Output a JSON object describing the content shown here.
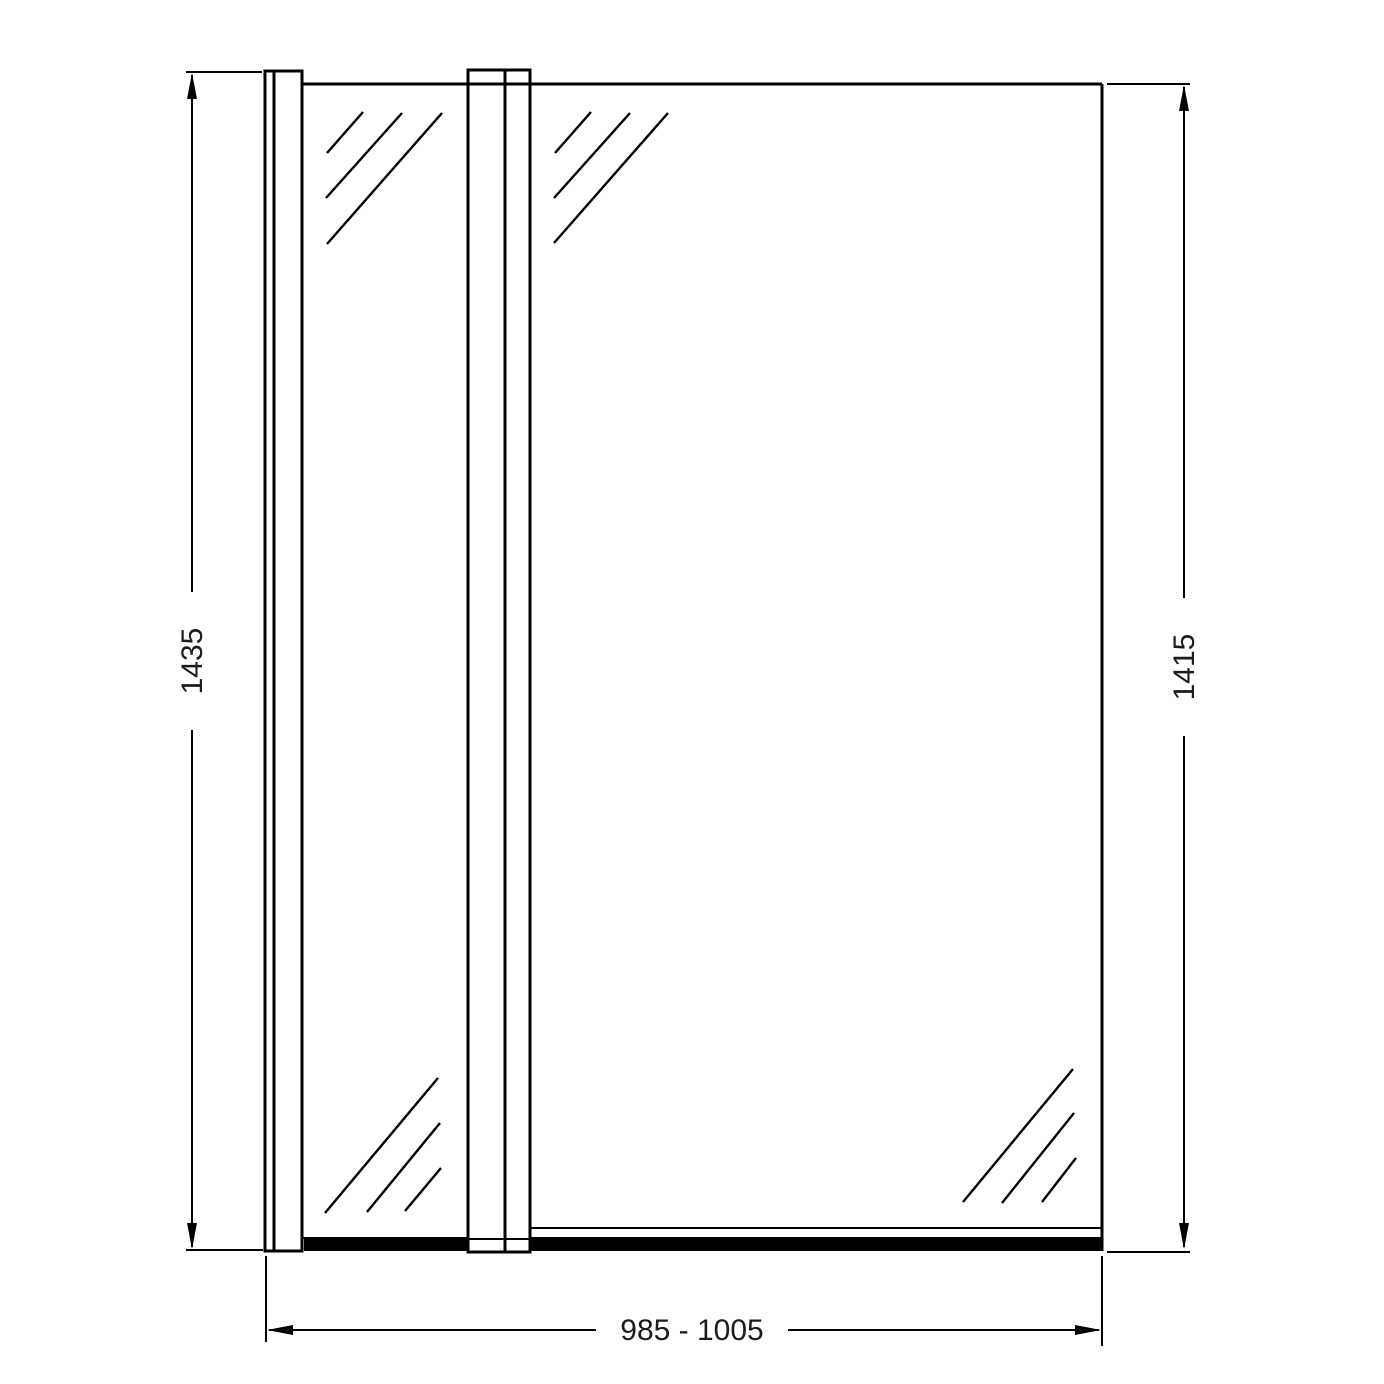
{
  "drawing": {
    "kind": "technical-dimension-drawing",
    "subject": "bath-shower-screen-front-elevation",
    "colors": {
      "background": "#ffffff",
      "line": "#000000",
      "seal": "#000000",
      "text": "#1b1b1b"
    },
    "dimensions": {
      "left_height_label": "1435",
      "right_height_label": "1415",
      "bottom_width_label": "985 - 1005"
    }
  }
}
